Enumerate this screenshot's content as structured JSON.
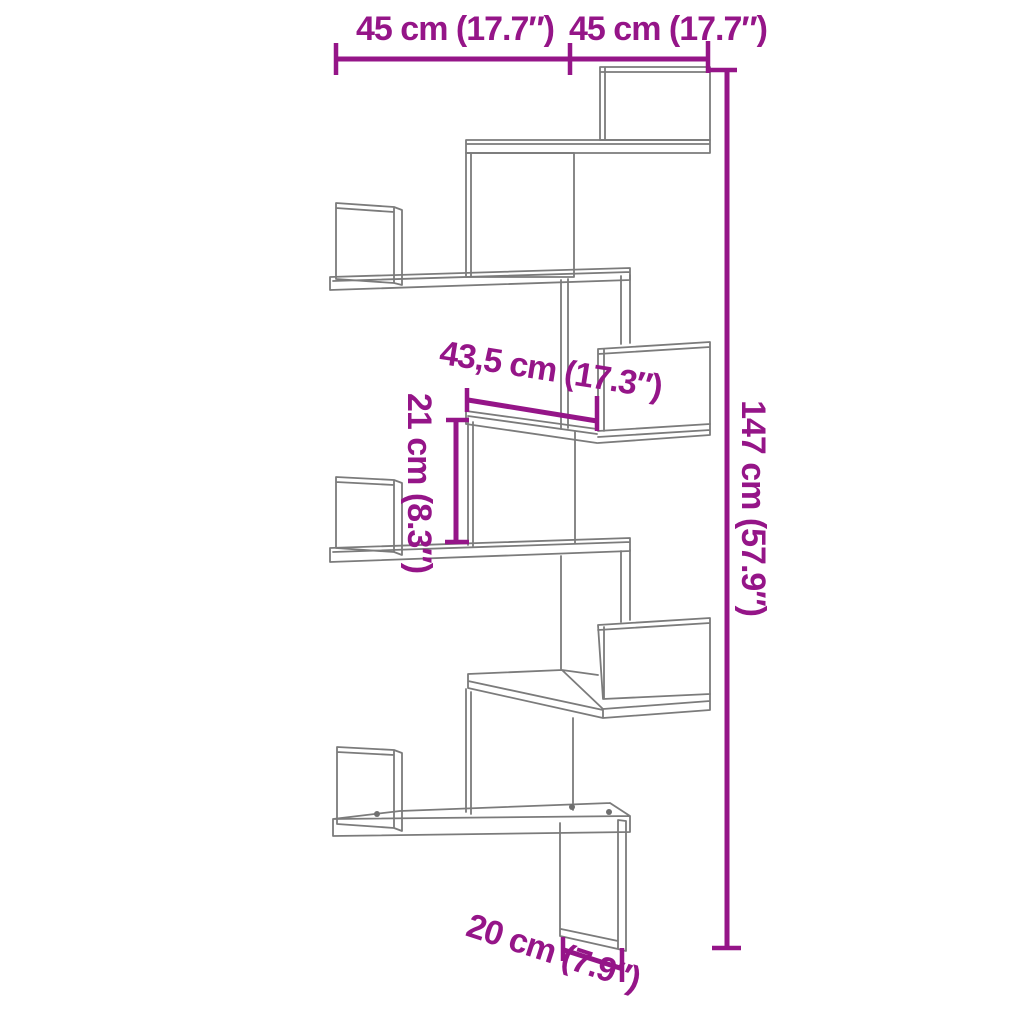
{
  "diagram": {
    "type": "product-dimension-diagram",
    "subject": "corner wall shelf (zigzag, 6 tiers)",
    "background_color": "#ffffff",
    "drawing_line_color": "#7b7b7b",
    "dimension_color": "#951588",
    "dimensions": {
      "top_width_left": "45 cm (17.7″)",
      "top_width_right": "45 cm (17.7″)",
      "middle_shelf_width": "43,5 cm (17.3″)",
      "shelf_gap_height": "21 cm (8.3″)",
      "total_height": "147 cm (57.9″)",
      "bottom_panel_width": "20 cm (7.9″)"
    }
  }
}
